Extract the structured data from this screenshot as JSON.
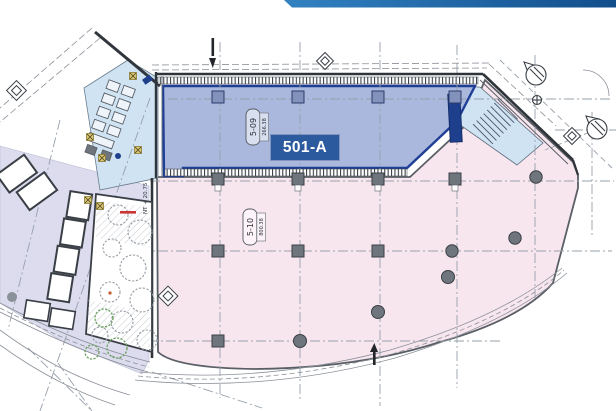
{
  "banner": {
    "gradient_left": "#3282c2",
    "gradient_right": "#124e8c"
  },
  "badge": {
    "label": "501-A",
    "bg": "#2b5a9e",
    "fg": "#ffffff"
  },
  "units": [
    {
      "id": "5-09",
      "area": "266.38",
      "fill": "#a9b8dc",
      "border": "#1f3e96",
      "status": "highlighted"
    },
    {
      "id": "5-10",
      "area": "800.38",
      "fill": "#f8e6ef",
      "border": "#5a5f66",
      "status": "normal"
    }
  ],
  "annotations": {
    "level_note": "NT + 20.75"
  },
  "colors": {
    "lavender_zone": "#dcdcee",
    "core_blue": "#cfe3f3",
    "wall": "#31363d",
    "grid_line": "#97a0ab",
    "column_gray": "#6e757d",
    "column_blue": "#8292bb",
    "navy_block": "#1d3f8c",
    "tree_gray": "#959ba2",
    "tree_green": "#69a05a",
    "marker_yellow": "#d9c57c",
    "accent_red": "#cc3333"
  }
}
